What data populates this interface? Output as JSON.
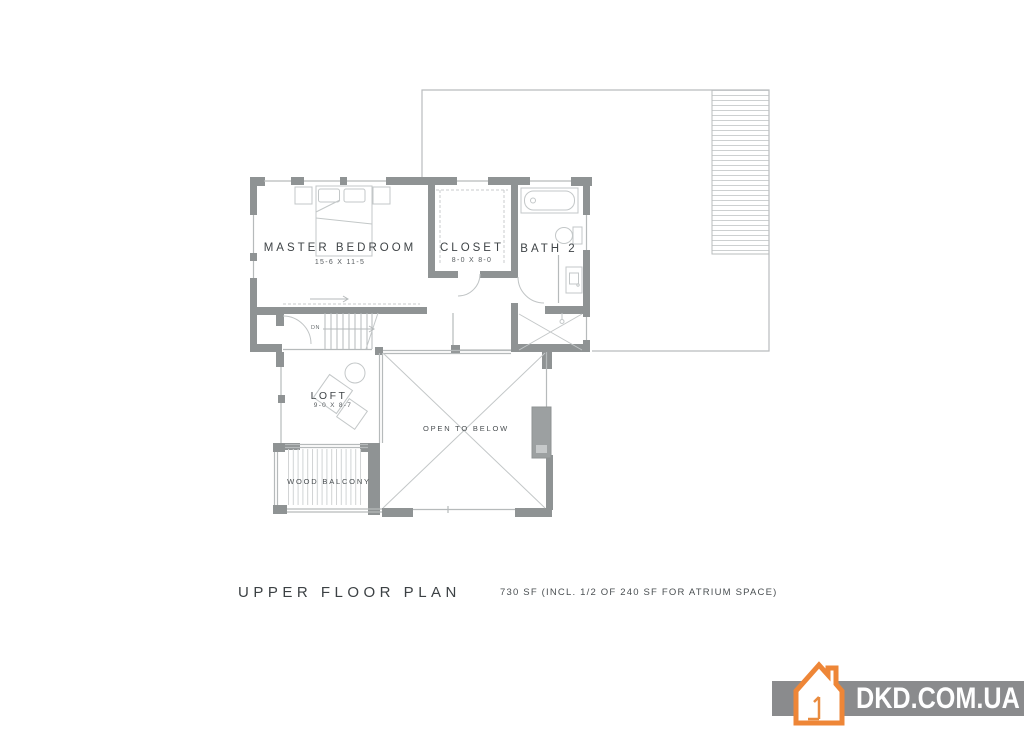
{
  "plan": {
    "title": "UPPER FLOOR PLAN",
    "area_note": "730 SF (INCL. 1/2 OF 240 SF FOR ATRIUM SPACE)",
    "rooms": {
      "master_bedroom": {
        "label": "MASTER BEDROOM",
        "dimensions": "15-6 X 11-5"
      },
      "closet": {
        "label": "CLOSET",
        "dimensions": "8-0 X 8-0"
      },
      "bath2": {
        "label": "BATH 2"
      },
      "loft": {
        "label": "LOFT",
        "dimensions": "9-0 X 8-7"
      },
      "open_to_below": {
        "label": "OPEN TO BELOW"
      },
      "wood_balcony": {
        "label": "WOOD BALCONY"
      },
      "stairs": {
        "direction_label": "DN"
      }
    }
  },
  "watermark": {
    "text": "DKD.COM.UA",
    "band_color": "#8a8b8d",
    "accent_color": "#ee8637"
  },
  "colors": {
    "wall": "#8f9394",
    "thin_line": "#b6babb",
    "furniture_line": "#c3c7c8",
    "label_text": "#3f4447"
  }
}
